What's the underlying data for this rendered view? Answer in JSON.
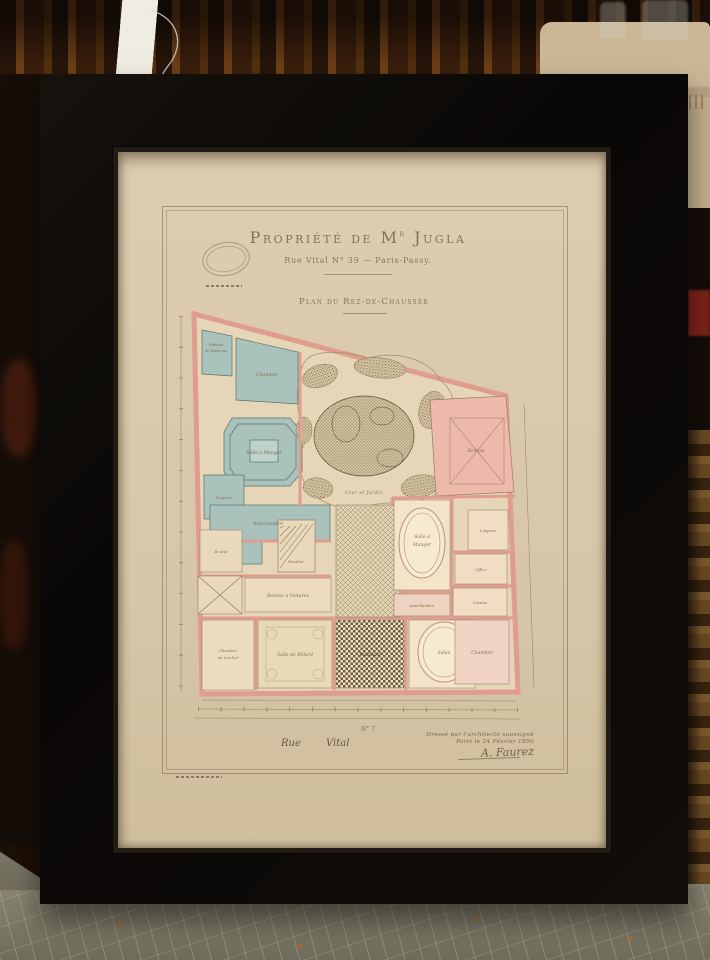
{
  "palette": {
    "frame_black": "#0b0908",
    "mat_cream": "#d8c7a9",
    "wall_pink": "#e6a291",
    "room_blue": "#a3bfb9",
    "plan_paper": "#e6d5b6",
    "ink_brown": "#73604a",
    "floor_grey": "#7d7a68"
  },
  "print": {
    "title_main": "Propriété de M",
    "title_sup": "r",
    "title_end": " Jugla",
    "subtitle": "Rue Vital N° 39 — Paris-Passy.",
    "plan_caption": "Plan du Rez-de-Chaussée",
    "garden_label": "Cour et Jardin",
    "dimension_note": "N° 7",
    "street": {
      "word1": "Rue",
      "word2": "Vital"
    },
    "signature": {
      "line1": "Dressé par l'architecte soussigné",
      "line2": "Paris le 24 Février 1890",
      "name": "A. Faurez"
    },
    "rooms": {
      "cabinet": "Cabinet",
      "cabinet2": "de Débarras",
      "chambre_bleue": "Chambre",
      "salle_manger_anc": "Salle à Manger",
      "lingerie_g": "Lingerie",
      "antichambre_b": "Antichambre",
      "ecurie": "Écurie",
      "remise_voitures": "Remise à Voitures",
      "chambre_cocher": "Chambre",
      "chambre_cocher2": "de Cocher",
      "billard": "Salle de Billard",
      "vestibule": "Vestibule",
      "salon": "Salon",
      "chambre_d": "Chambre",
      "sam1": "Salle à",
      "sam2": "Manger",
      "antichambre_d": "Antichambre",
      "lingerie_d": "Lingerie",
      "office": "Office",
      "cuisine": "Cuisine",
      "remise": "Remise",
      "escalier": "Escalier"
    }
  }
}
